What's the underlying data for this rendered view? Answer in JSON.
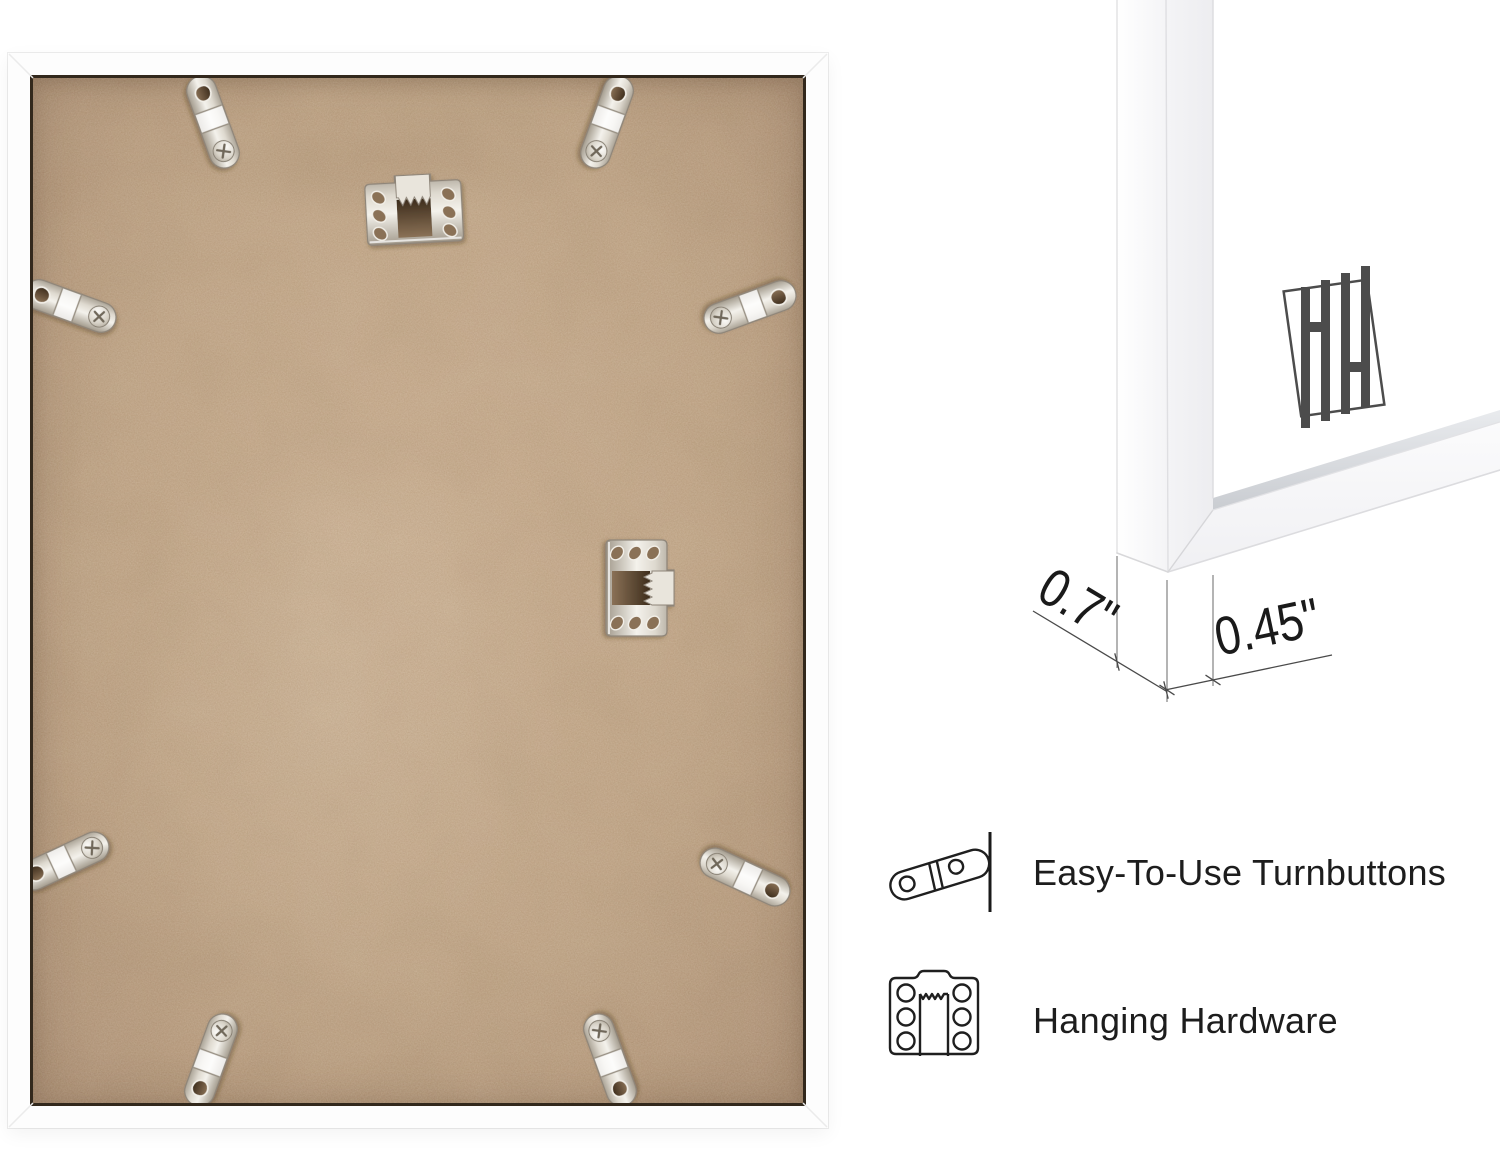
{
  "canvas": {
    "width": 1500,
    "height": 1156,
    "background": "#ffffff"
  },
  "palette": {
    "mdf": "#c6ab8c",
    "mdf_light": "#cfb496",
    "mdf_shadow": "#b3967a",
    "frame_white": "#fdfdfd",
    "rabbet_line": "#32281c",
    "metal_light": "#f3f1ec",
    "metal_mid": "#c6bfb4",
    "metal_dark": "#948c80",
    "hole_dark": "#5e4b35",
    "glass_edge": "#d2d5d9",
    "logo": "#4c4c4c",
    "dimension_line": "#4a4a4a",
    "text": "#1d1d1d"
  },
  "frame_back": {
    "hardware": {
      "turnbutton_count": 8,
      "sawtooth_hanger_count": 2
    }
  },
  "closeup": {
    "logo_monogram": "HH",
    "dimensions": {
      "depth": "0.7\"",
      "face_width": "0.45\""
    }
  },
  "features": [
    {
      "icon": "turnbutton-icon",
      "label": "Easy-To-Use Turnbuttons"
    },
    {
      "icon": "sawtooth-hanger-icon",
      "label": "Hanging Hardware"
    }
  ]
}
